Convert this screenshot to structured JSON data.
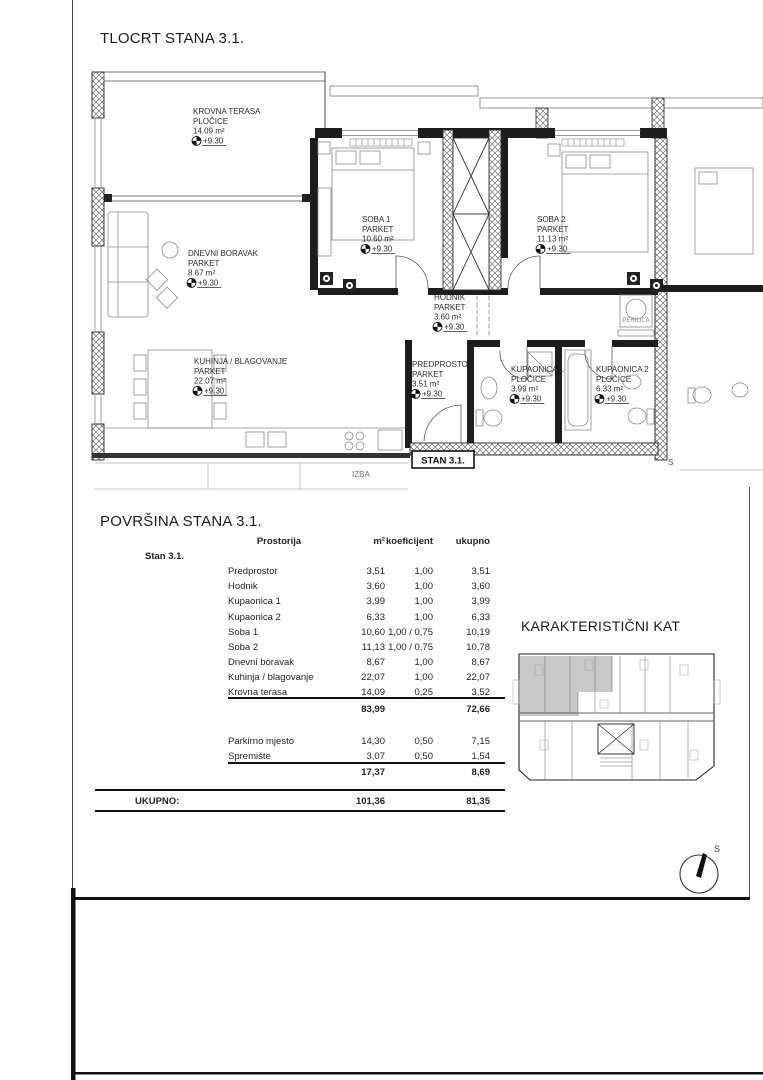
{
  "page": {
    "plan_title": "TLOCRT STANA 3.1.",
    "table_title": "POVRŠINA STANA 3.1.",
    "keyplan_title": "KARAKTERISTIČNI KAT",
    "compass_label": "S"
  },
  "plan": {
    "apartment_tag": "STAN 3.1.",
    "rooms": [
      {
        "id": "krovna-terasa",
        "lines": [
          "KROVNA TERASA",
          "PLOČICE",
          "14.09 m²"
        ],
        "level": "+9.30",
        "x": 193,
        "y": 114
      },
      {
        "id": "dnevni-boravak",
        "lines": [
          "DNEVNI BORAVAK",
          "PARKET",
          "8.67 m²"
        ],
        "level": "+9.30",
        "x": 188,
        "y": 256
      },
      {
        "id": "kuhinja-blagovanje",
        "lines": [
          "KUHINJA / BLAGOVANJE",
          "PARKET",
          "22.07 m²"
        ],
        "level": "+9.30",
        "x": 194,
        "y": 364
      },
      {
        "id": "soba-1",
        "lines": [
          "SOBA 1",
          "PARKET",
          "10.60 m²"
        ],
        "level": "+9.30",
        "x": 362,
        "y": 222
      },
      {
        "id": "soba-2",
        "lines": [
          "SOBA 2",
          "PARKET",
          "11.13 m²"
        ],
        "level": "+9.30",
        "x": 537,
        "y": 222
      },
      {
        "id": "hodnik",
        "lines": [
          "HODNIK",
          "PARKET",
          "3.60 m²"
        ],
        "level": "+9.30",
        "x": 434,
        "y": 300
      },
      {
        "id": "predprostor",
        "lines": [
          "PREDPROSTOR",
          "PARKET",
          "3.51 m²"
        ],
        "level": "+9.30",
        "x": 412,
        "y": 367
      },
      {
        "id": "kupaonica-1",
        "lines": [
          "KUPAONICA 1",
          "PLOČICE",
          "3.99 m²"
        ],
        "level": "+9.30",
        "x": 511,
        "y": 372
      },
      {
        "id": "kupaonica-2",
        "lines": [
          "KUPAONICA 2",
          "PLOČICE",
          "6.33 m²"
        ],
        "level": "+9.30",
        "x": 596,
        "y": 372
      }
    ],
    "small_labels": [
      {
        "id": "perilica",
        "text": "PERILICA",
        "x": 636,
        "y": 322,
        "size": 6,
        "color": "#8a8a8a",
        "anchor": "middle"
      },
      {
        "id": "izba",
        "text": "IZBA",
        "x": 352,
        "y": 477,
        "size": 8,
        "color": "#777777",
        "anchor": "start"
      },
      {
        "id": "cut-label-s",
        "text": "S",
        "x": 668,
        "y": 465,
        "size": 8,
        "color": "#555555",
        "anchor": "start"
      }
    ]
  },
  "table": {
    "group_label": "Stan 3.1.",
    "columns": {
      "name": "Prostorija",
      "m2": "m²",
      "koef": "koeficijent",
      "ukupno": "ukupno"
    },
    "rows": [
      {
        "name": "Predprostor",
        "m2": "3,51",
        "koef": "1,00",
        "ukupno": "3,51"
      },
      {
        "name": "Hodnik",
        "m2": "3,60",
        "koef": "1,00",
        "ukupno": "3,60"
      },
      {
        "name": "Kupaonica 1",
        "m2": "3,99",
        "koef": "1,00",
        "ukupno": "3,99"
      },
      {
        "name": "Kupaonica 2",
        "m2": "6,33",
        "koef": "1,00",
        "ukupno": "6,33"
      },
      {
        "name": "Soba 1",
        "m2": "10,60",
        "koef": "1,00 / 0,75",
        "ukupno": "10,19"
      },
      {
        "name": "Soba 2",
        "m2": "11,13",
        "koef": "1,00 / 0,75",
        "ukupno": "10,78"
      },
      {
        "name": "Dnevni boravak",
        "m2": "8,67",
        "koef": "1,00",
        "ukupno": "8,67"
      },
      {
        "name": "Kuhinja / blagovanje",
        "m2": "22,07",
        "koef": "1,00",
        "ukupno": "22,07"
      },
      {
        "name": "Krovna terasa",
        "m2": "14,09",
        "koef": "0,25",
        "ukupno": "3,52"
      }
    ],
    "subtotal1": {
      "m2": "83,99",
      "ukupno": "72,66"
    },
    "extra_rows": [
      {
        "name": "Parkirno mjesto",
        "m2": "14,30",
        "koef": "0,50",
        "ukupno": "7,15"
      },
      {
        "name": "Spremište",
        "m2": "3,07",
        "koef": "0,50",
        "ukupno": "1,54"
      }
    ],
    "subtotal2": {
      "m2": "17,37",
      "ukupno": "8,69"
    },
    "total_label": "UKUPNO:",
    "total": {
      "m2": "101,36",
      "ukupno": "81,35"
    }
  }
}
